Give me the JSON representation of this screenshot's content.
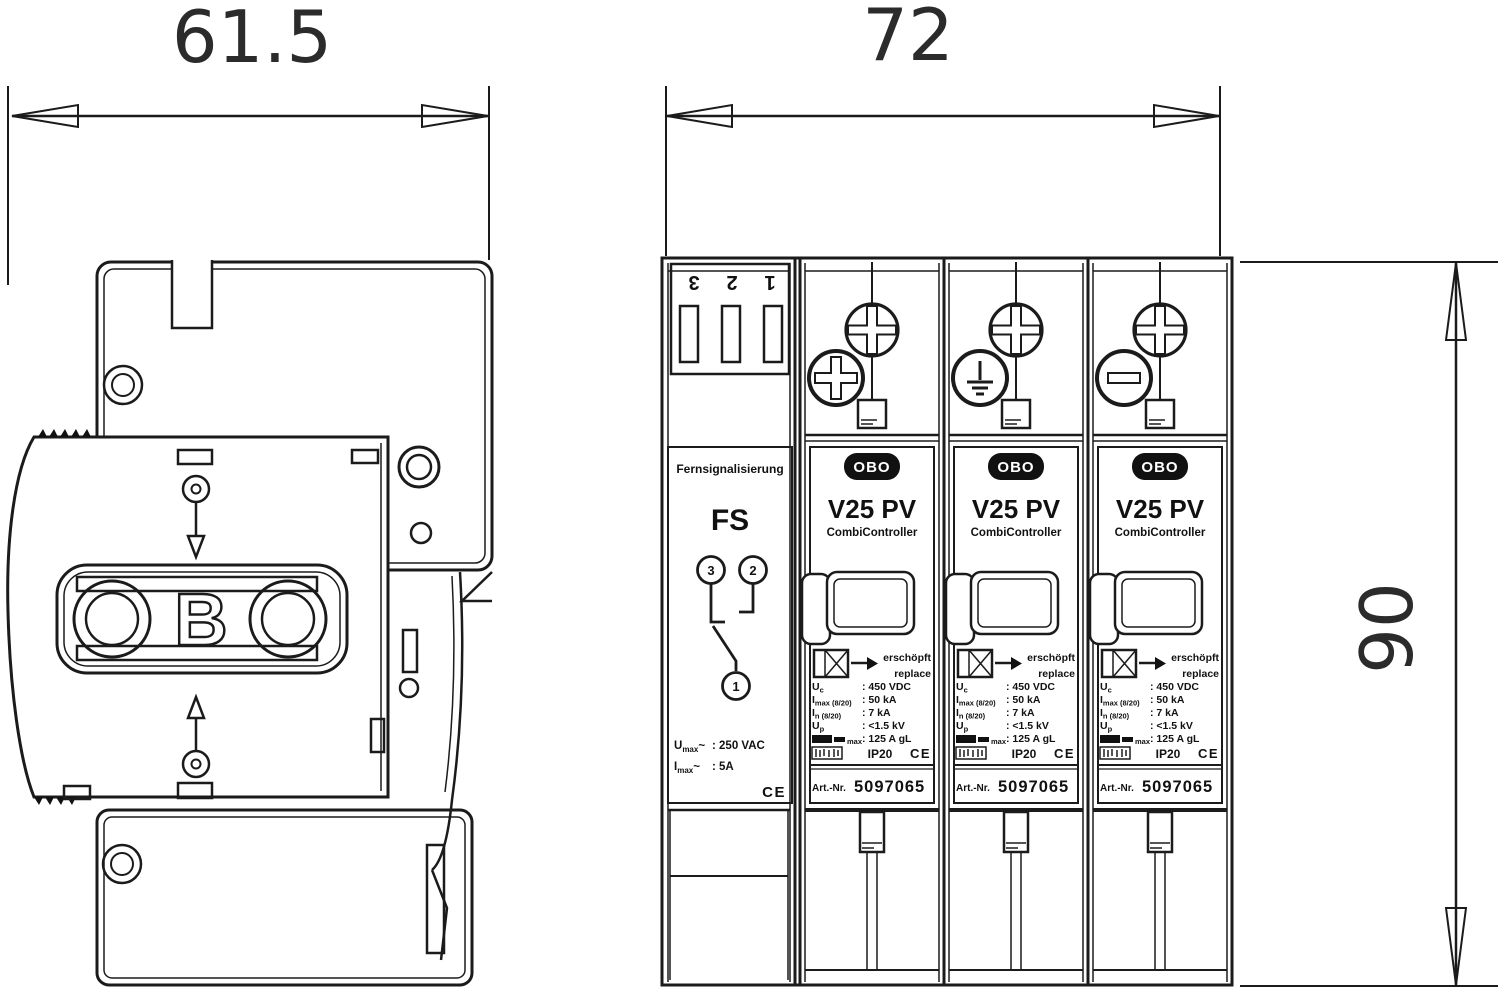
{
  "dims": {
    "side_width": "61.5",
    "front_width": "72",
    "height": "90"
  },
  "side_view": {
    "logo_letter": "B"
  },
  "fs": {
    "terminals": [
      "3",
      "2",
      "1"
    ],
    "heading_small": "Fernsignalisierung",
    "heading": "FS",
    "contact_left": "3",
    "contact_right": "2",
    "contact_common": "1",
    "rating_rows": [
      {
        "sym": "U",
        "sub": "max",
        "tilde": "~",
        "value": ": 250 VAC"
      },
      {
        "sym": "I",
        "sub": "max",
        "tilde": "~",
        "value": ": 5A"
      }
    ],
    "ce": "CE"
  },
  "v25": {
    "logo": "OBO",
    "model": "V25  PV",
    "subtitle": "CombiController",
    "indicator_de": "erschöpft",
    "indicator_en": "replace",
    "specs": [
      {
        "sym": "U",
        "sub": "c",
        "value": ": 450 VDC"
      },
      {
        "sym": "I",
        "sub": "max (8/20)",
        "value": ": 50 kA"
      },
      {
        "sym": "I",
        "sub": "n (8/20)",
        "value": ": 7 kA"
      },
      {
        "sym": "U",
        "sub": "p",
        "value": ": <1.5 kV"
      },
      {
        "sym": "",
        "sub": "max",
        "value": ": 125 A gL"
      }
    ],
    "ip": "IP20",
    "ce": "CE",
    "art_label": "Art.-Nr.",
    "art_no": "5097065"
  },
  "screw_symbols": {
    "module1": "plus",
    "module2": "earth",
    "module3": "minus"
  }
}
